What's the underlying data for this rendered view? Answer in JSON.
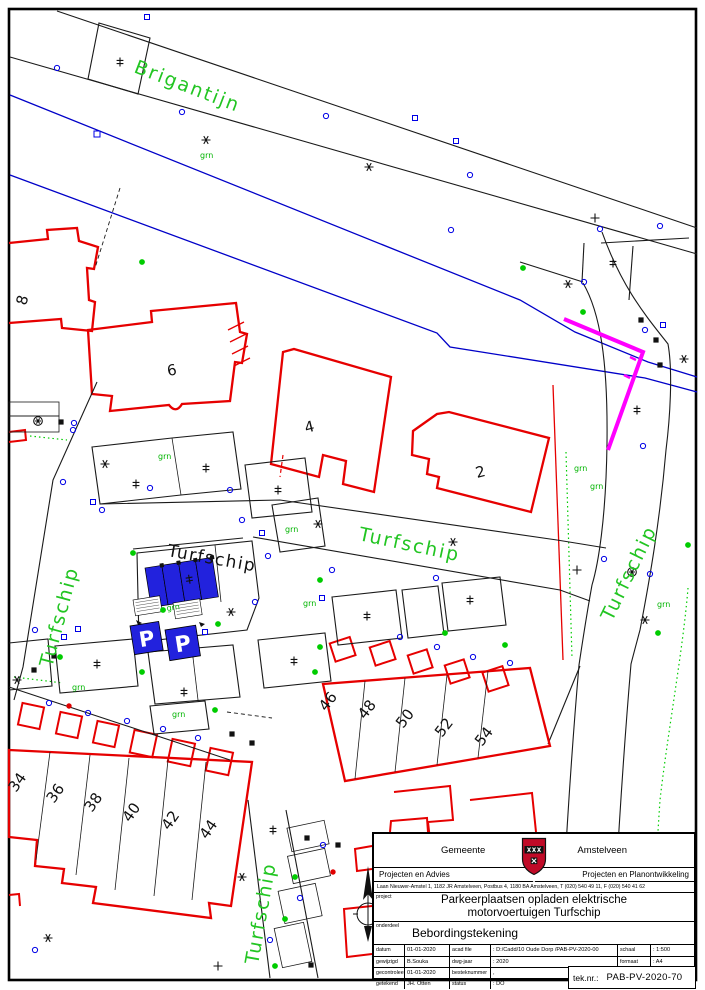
{
  "map": {
    "street_labels": [
      {
        "id": "brigantijn",
        "text": "Brigantijn"
      },
      {
        "id": "turfschip-center-black",
        "text": "Turfschip"
      },
      {
        "id": "turfschip-center-green",
        "text": "Turfschip"
      },
      {
        "id": "turfschip-left",
        "text": "Turfschip"
      },
      {
        "id": "turfschip-right",
        "text": "Turfschip"
      },
      {
        "id": "turfschip-bottom",
        "text": "Turfschip"
      }
    ],
    "grn_label": "grn",
    "parking_sign_letter": "P",
    "house_numbers": [
      {
        "text": "8"
      },
      {
        "text": "6"
      },
      {
        "text": "4"
      },
      {
        "text": "2"
      },
      {
        "text": "34"
      },
      {
        "text": "36"
      },
      {
        "text": "38"
      },
      {
        "text": "40"
      },
      {
        "text": "42"
      },
      {
        "text": "44"
      },
      {
        "text": "46"
      },
      {
        "text": "48"
      },
      {
        "text": "50"
      },
      {
        "text": "52"
      },
      {
        "text": "54"
      }
    ],
    "colors": {
      "building_outline_red": "#e60000",
      "water_line_blue": "#0000c8",
      "parking_fill_blue": "#2222dd",
      "marking_magenta": "#ff00ff",
      "street_label_green": "#22c522",
      "dot_green": "#00cc00",
      "symbol_blue": "#0000e6"
    }
  },
  "title_block": {
    "municipality_left": "Gemeente",
    "municipality_right": "Amstelveen",
    "department_left": "Projecten en Advies",
    "department_right": "Projecten en Planontwikkeling",
    "address": "Laan Nieuwer-Amstel 1, 1182 JR Amstelveen, Postbus 4, 1180 BA Amstelveen, T (020) 540 49 11, F (020) 540 41 62",
    "project_label": "project",
    "project_title_line1": "Parkeerplaatsen opladen elektrische",
    "project_title_line2": "motorvoertuigen Turfschip",
    "onderdeel_label": "onderdeel",
    "onderdeel_value": "Bebordingstekening",
    "fields": {
      "datum_label": "datum",
      "datum_value": "01-01-2020",
      "acadfile_label": "acad file",
      "acadfile_value": ": D:/Cadd/10 Oude Dorp /PAB-PV-2020-00",
      "schaal_label": "schaal",
      "schaal_value": ": 1:500",
      "gewijzigd_label": "gewijzigd",
      "gewijzigd_value": "B.Souka",
      "dwgjaar_label": "dwg-jaar",
      "dwgjaar_value": ": 2020",
      "formaat_label": "formaat",
      "formaat_value": ": A4",
      "gecontroleerd_label": "gecontroleerd",
      "gecontroleerd_value": "01-01-2020",
      "besteknummer_label": "besteknummer",
      "besteknummer_value": ",",
      "getekend_label": "getekend",
      "getekend_value": "JH. Otten",
      "status_label": "status",
      "status_value": ": DO",
      "teknr_label": "tek.nr.:",
      "teknr_value": "PAB-PV-2020-70"
    }
  }
}
